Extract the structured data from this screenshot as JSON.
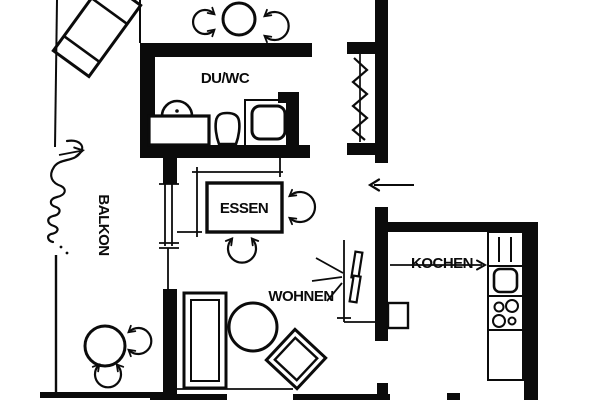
{
  "colors": {
    "wall": "#0b0b0b",
    "background": "#ffffff"
  },
  "rooms": [
    {
      "key": "balkon",
      "label": "BALKON"
    },
    {
      "key": "duwc",
      "label": "DU/WC"
    },
    {
      "key": "essen",
      "label": "ESSEN"
    },
    {
      "key": "wohnen",
      "label": "WOHNEN"
    },
    {
      "key": "kochen",
      "label": "KOCHEN"
    }
  ]
}
